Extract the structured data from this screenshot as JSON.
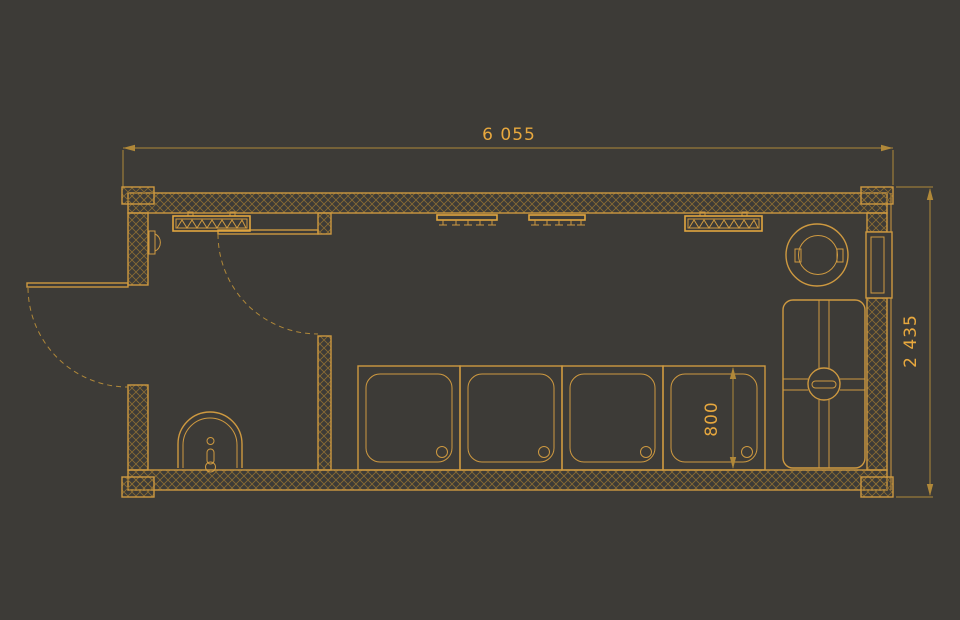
{
  "palette": {
    "background": "#3D3B37",
    "line": "#CE9940",
    "line_bright": "#E2A63F",
    "hatch": "#8A6C33",
    "dim_line": "#B08839",
    "text": "#E8A83E"
  },
  "drawing": {
    "type": "floor-plan",
    "dimensions": {
      "overall_length": "6 055",
      "overall_depth": "2 435",
      "tray_width": "800"
    },
    "fixtures": [
      "entrance-door",
      "interior-door",
      "partition-wall",
      "radiator-left",
      "radiator-right",
      "coat-hook-rail-left",
      "coat-hook-rail-right",
      "toilet",
      "shower-tray-1",
      "shower-tray-2",
      "shower-tray-3",
      "shower-tray-4",
      "water-heater",
      "shower-unit",
      "window",
      "wall-handle"
    ],
    "counts": {
      "shower_trays": 4,
      "hooks_per_rail": 5,
      "radiators": 2
    }
  }
}
